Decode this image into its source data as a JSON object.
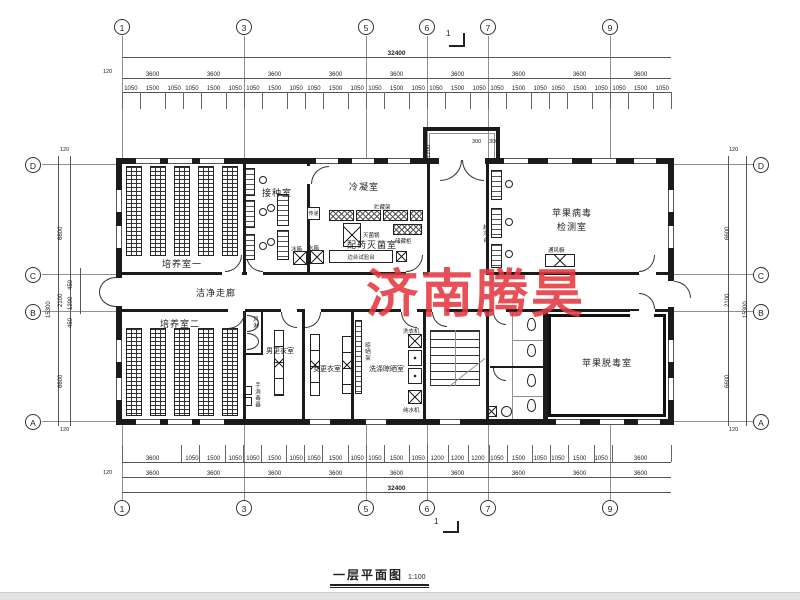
{
  "title": {
    "text": "一层平面图",
    "scale": "1:100"
  },
  "watermark": {
    "text": "济南腾昊",
    "color": "#e4383f"
  },
  "grid": {
    "cols": [
      "1",
      "3",
      "5",
      "6",
      "7",
      "9"
    ],
    "rows": [
      "D",
      "C",
      "B",
      "A"
    ],
    "section": "1"
  },
  "dims": {
    "total_width": "32400",
    "total_height": "15300",
    "edge": "120",
    "bays": [
      "3600",
      "3600",
      "3600",
      "3600",
      "3600",
      "3600",
      "3600",
      "3600",
      "3600"
    ],
    "top_small": [
      "1050",
      "1500",
      "1050",
      "1050",
      "1500",
      "1050",
      "1050",
      "1500",
      "1050",
      "1050",
      "1500",
      "1050",
      "1050",
      "1500",
      "1050",
      "1050",
      "1500",
      "1050",
      "1050",
      "1500",
      "1050",
      "1050",
      "1500",
      "1050",
      "1050",
      "1500",
      "1050"
    ],
    "bottom_small": [
      "3600",
      "1050",
      "1500",
      "1050",
      "1050",
      "1500",
      "1050",
      "1050",
      "1500",
      "1050",
      "1050",
      "1500",
      "1050",
      "1200",
      "1200",
      "1200",
      "1050",
      "1500",
      "1050",
      "1050",
      "1500",
      "1050",
      "3600"
    ],
    "left_segments": [
      "6600",
      "2100",
      "6600"
    ],
    "left_sub": [
      "450",
      "1200",
      "450"
    ],
    "porch_depth": "1200",
    "porch_side": "300"
  },
  "rooms": {
    "culture1": "培养室一",
    "inoculation": "接种室",
    "condensing": "冷凝室",
    "dispensing": "配药灭菌室",
    "virus_line1": "苹果病毒",
    "virus_line2": "检测室",
    "corridor": "洁净走廊",
    "culture2": "培养室二",
    "men": "男更衣室",
    "women": "女更衣室",
    "laundry": "洗涤晾晒室",
    "detox": "苹果脱毒室"
  },
  "equip": {
    "pass": "传递",
    "rack": "贮藏架",
    "sterilizer": "灭菌锅",
    "cabinet": "储藏柜",
    "bench": "边台试验台",
    "tank": "水箱",
    "fridge": "冰箱",
    "clean_bench": "超净台",
    "fume": "通风橱",
    "air_shower": "风淋",
    "sanitizer": "手消毒器",
    "washer": "洗衣机",
    "purifier": "纯水机",
    "dry_rack": "晾晒架"
  }
}
